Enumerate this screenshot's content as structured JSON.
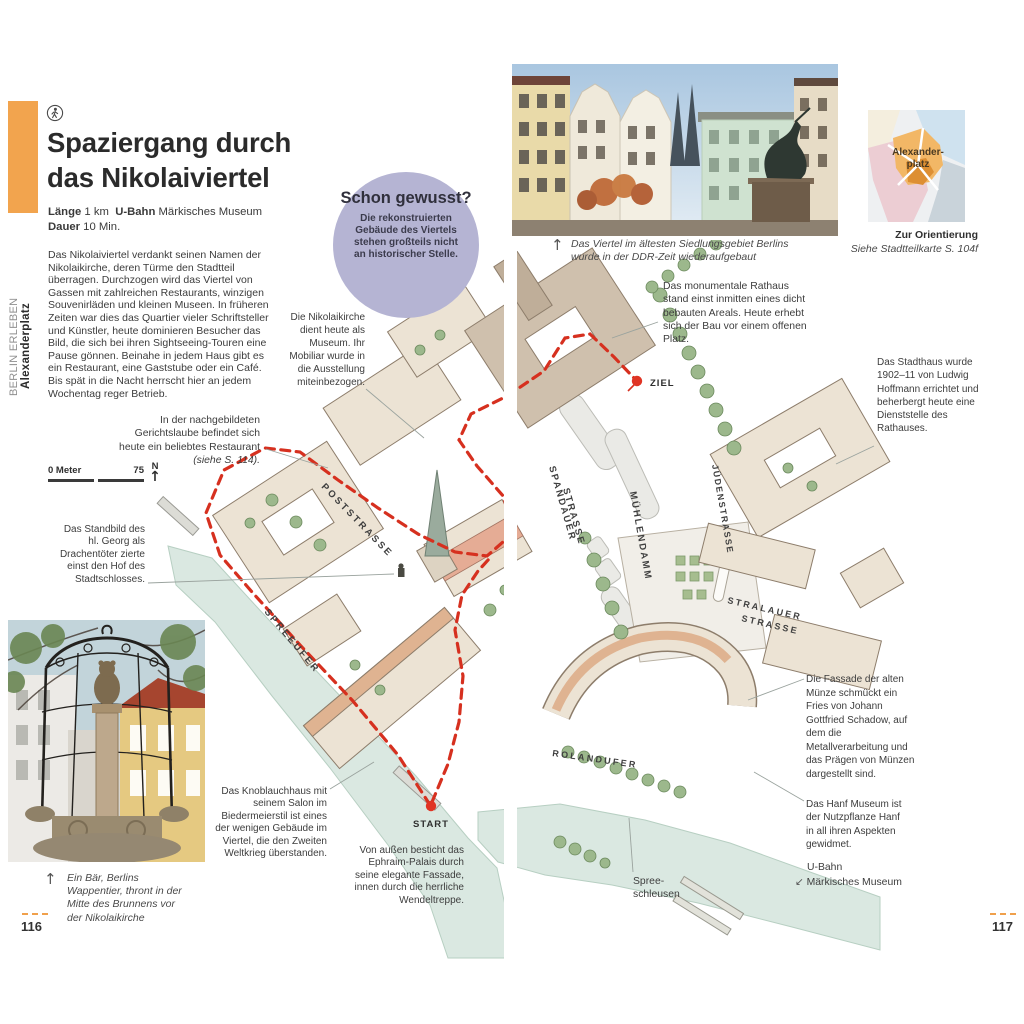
{
  "colors": {
    "accent_orange": "#F2A44E",
    "badge_lavender": "#B5B4D3",
    "route_red": "#D6301F",
    "river_green": "#DAE8E1"
  },
  "sidebar": {
    "series": "BERLIN ERLEBEN",
    "district": "Alexanderplatz"
  },
  "header": {
    "title": "Spaziergang durch das Nikolaiviertel"
  },
  "tour_info": {
    "length_label": "Länge",
    "length_value": "1 km",
    "ubahn_label": "U-Bahn",
    "ubahn_value": "Märkisches Museum",
    "duration_label": "Dauer",
    "duration_value": "10 Min."
  },
  "intro": "Das Nikolaiviertel verdankt seinen Namen der Nikolaikirche, deren Türme den Stadtteil überragen. Durchzogen wird das Viertel von Gassen mit zahlreichen Restaurants, winzigen Souvenirläden und kleinen Museen. In früheren Zeiten war dies das Quartier vieler Schriftsteller und Künstler, heute dominieren Besucher das Bild, die sich bei ihren Sightseeing-Touren eine Pause gönnen. Beinahe in jedem Haus gibt es ein Restaurant, eine Gaststube oder ein Café. Bis spät in die Nacht herrscht hier an jedem Wochentag reger Betrieb.",
  "did_you_know": {
    "title": "Schon gewusst?",
    "body": "Die rekonstruierten Gebäude des Viertels stehen großteils nicht an historischer Stelle."
  },
  "captions": {
    "top_photo": "Das Viertel im ältesten Siedlungsgebiet Berlins wurde in der DDR-Zeit wiederaufgebaut",
    "bottom_photo": "Ein Bär, Berlins Wappentier, thront in der Mitte des Brunnens vor der Nikolaikirche"
  },
  "orientation": {
    "label_line1": "Alexander-",
    "label_line2": "platz",
    "caption_title": "Zur Orientierung",
    "caption_sub": "Siehe Stadtteilkarte S. 104f"
  },
  "notes": {
    "nikolaikirche": "Die Nikolaikirche dient heute als Museum. Ihr Mobiliar wurde in die Ausstellung miteinbezogen.",
    "gerichtslaube": "In der nachgebildeten Gerichtslaube befindet sich heute ein beliebtes Restaurant ",
    "gerichtslaube_ref": "(siehe S. 114).",
    "standbild": "Das Standbild des hl. Georg als Drachentöter zierte einst den Hof des Stadtschlosses.",
    "knoblauchhaus": "Das Knoblauchhaus mit seinem Salon im Biedermeierstil ist eines der wenigen Gebäude im Viertel, die den Zweiten Weltkrieg überstanden.",
    "ephraim": "Von außen besticht das Ephraim-Palais durch seine elegante Fassade, innen durch die herrliche Wendeltreppe.",
    "rathaus": "Das monumentale Rathaus stand einst inmitten eines dicht bebauten Areals. Heute erhebt sich der Bau vor einem offenen Platz.",
    "stadthaus": "Das Stadthaus wurde 1902–11 von Ludwig Hoffmann errichtet und beherbergt heute eine Dienststelle des Rathauses.",
    "muenze": "Die Fassade der alten Münze schmückt ein Fries von Johann Gottfried Schadow, auf dem die Metallverarbeitung und das Prägen von Münzen dargestellt sind.",
    "hanf": "Das Hanf Museum ist der Nutzpflanze Hanf in all ihren Aspekten gewidmet.",
    "ubahn_line1": "U-Bahn",
    "ubahn_line2": "Märkisches Museum",
    "spree_line1": "Spree-",
    "spree_line2": "schleusen"
  },
  "map": {
    "scale_zero": "0 Meter",
    "scale_end": "75",
    "north": "N",
    "start": "START",
    "ziel": "ZIEL",
    "streets": {
      "poststrasse": "POSTSTRASSE",
      "spreeufer": "SPREEUFER",
      "spandauer_1": "SPANDAUER",
      "spandauer_2": "STRASSE",
      "muehlendamm": "MÜHLENDAMM",
      "juedenstrasse": "JÜDENSTRASSE",
      "stralauer_1": "STRALAUER",
      "stralauer_2": "STRASSE",
      "rolandufer": "ROLANDUFER"
    }
  },
  "pages": {
    "left": "116",
    "right": "117"
  },
  "glyphs": {
    "up_arrow": "↑",
    "down_left_arrow": "↙"
  }
}
